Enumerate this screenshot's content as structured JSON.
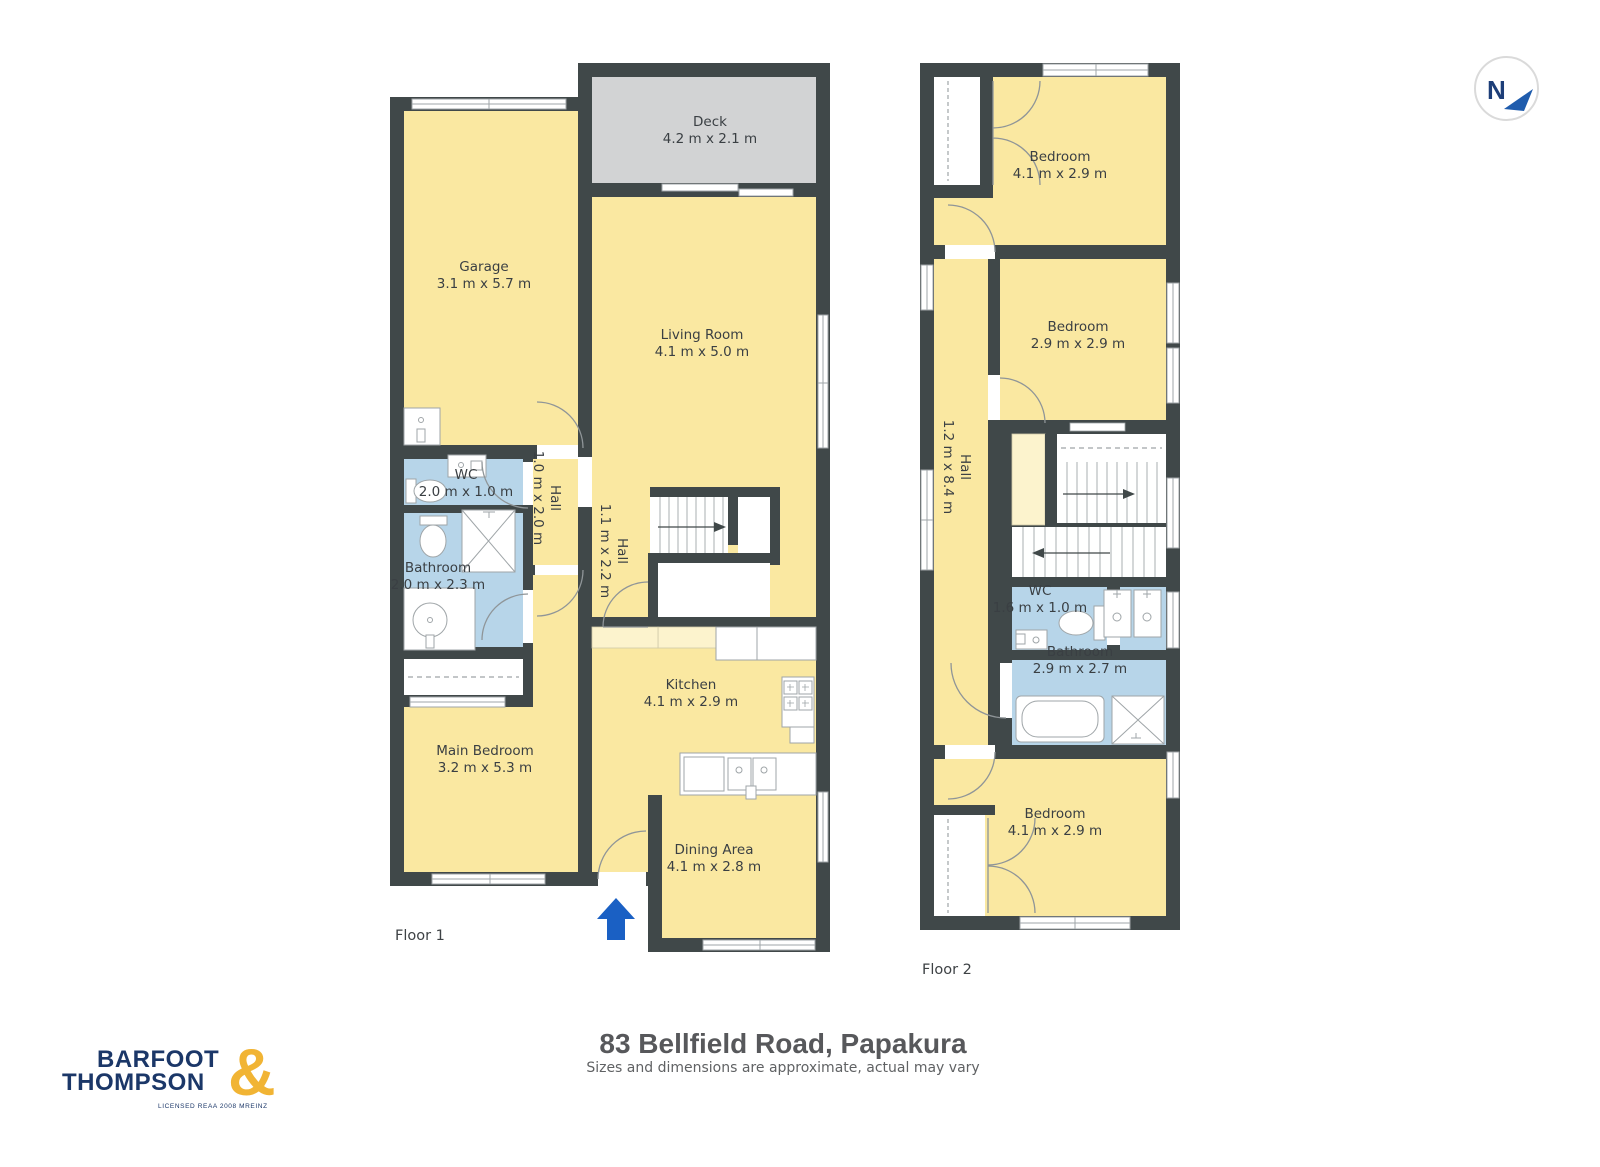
{
  "title": "83 Bellfield Road, Papakura",
  "subtitle": "Sizes and dimensions are approximate, actual may vary",
  "compass": {
    "north_label": "N"
  },
  "logo": {
    "word1": "BARFOOT",
    "word2": "THOMPSON",
    "ampersand": "&",
    "tagline": "LICENSED REAA 2008 MREINZ"
  },
  "colors": {
    "wall": "#404849",
    "room_yellow": "#fae8a1",
    "wet_blue": "#b7d5e9",
    "deck_gray": "#d2d3d4",
    "counter_cream": "#fcf3cd",
    "entrance_arrow_blue": "#1a60c4",
    "logo_navy": "#1b3768",
    "logo_gold": "#f1b434"
  },
  "floors": [
    {
      "label": "Floor 1",
      "rooms": [
        {
          "name": "Deck",
          "dims": "4.2 m x 2.1 m"
        },
        {
          "name": "Garage",
          "dims": "3.1 m x 5.7 m"
        },
        {
          "name": "Living Room",
          "dims": "4.1 m x 5.0 m"
        },
        {
          "name": "WC",
          "dims": "2.0 m x 1.0 m"
        },
        {
          "name": "Hall",
          "dims": "1.0 m x 2.0 m"
        },
        {
          "name": "Hall",
          "dims": "1.1 m x 2.2 m"
        },
        {
          "name": "Bathroom",
          "dims": "2.0 m x 2.3 m"
        },
        {
          "name": "Kitchen",
          "dims": "4.1 m x 2.9 m"
        },
        {
          "name": "Main Bedroom",
          "dims": "3.2 m x 5.3 m"
        },
        {
          "name": "Dining Area",
          "dims": "4.1 m x 2.8 m"
        }
      ]
    },
    {
      "label": "Floor 2",
      "rooms": [
        {
          "name": "Bedroom",
          "dims": "4.1 m x 2.9 m"
        },
        {
          "name": "Bedroom",
          "dims": "2.9 m x 2.9 m"
        },
        {
          "name": "Hall",
          "dims": "1.2 m x 8.4 m"
        },
        {
          "name": "WC",
          "dims": "1.6 m x 1.0 m"
        },
        {
          "name": "Bathroom",
          "dims": "2.9 m x 2.7 m"
        },
        {
          "name": "Bedroom",
          "dims": "4.1 m x 2.9 m"
        }
      ]
    }
  ]
}
